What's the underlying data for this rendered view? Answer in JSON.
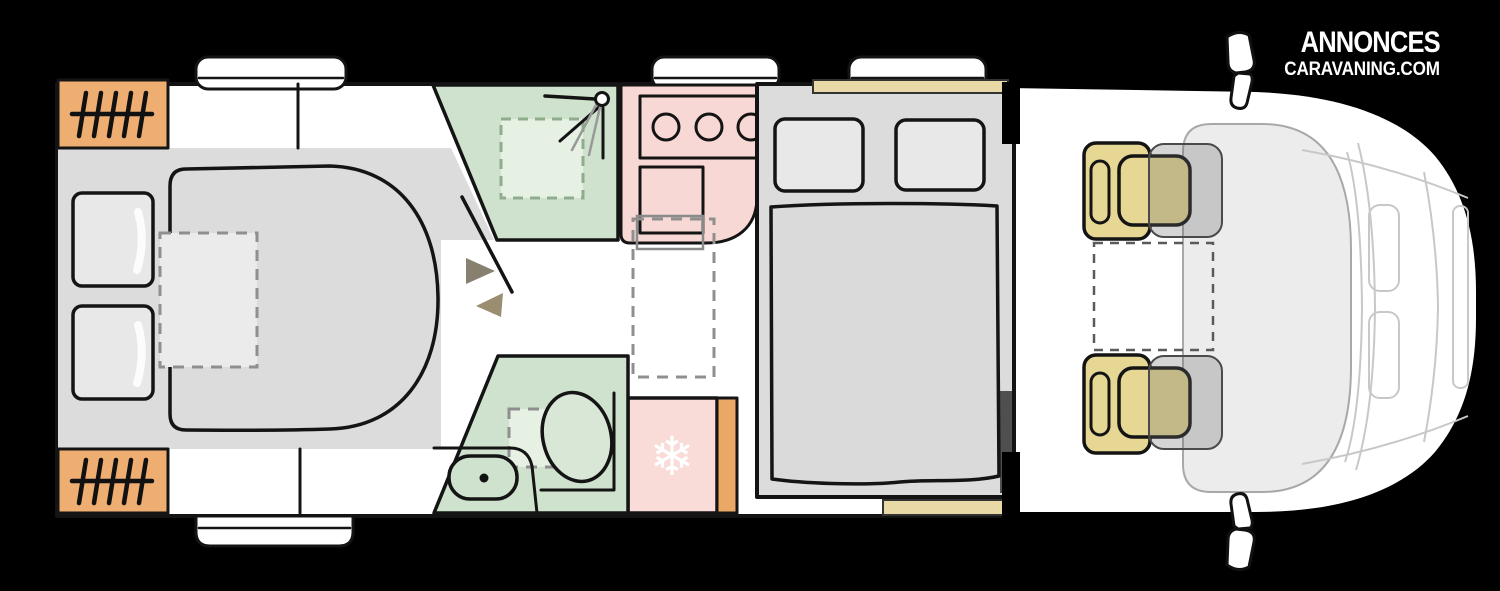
{
  "watermark": {
    "line1": "ANNONCES",
    "line2": "CARAVANING.COM"
  },
  "icons": {
    "snowflake": "❄"
  },
  "palette": {
    "background": "#000000",
    "body_white": "#ffffff",
    "outline_black": "#141414",
    "floor_gray": "#dcdcdc",
    "mattress_gray": "#dadada",
    "pillow_gray": "#e8e8e8",
    "heater_orange": "#efae71",
    "fridge_side_orange": "#e9a865",
    "kitchen_pink": "#f8d8d4",
    "fridge_pink": "#f9dcd8",
    "bath_green": "#cfe2cd",
    "bath_green_light": "#e6f0e3",
    "toilet_green": "#d9e8d6",
    "seat_khaki": "#e7d795",
    "shelf_tan": "#e9d9a7",
    "dash_gray": "#8f8f8f",
    "door_arrow_dark": "#87806f",
    "door_arrow_olive": "#9a8d70",
    "cab_glass_gray": "#ececec",
    "cab_line_gray": "#c8c8c8",
    "bed_side_shadow": "#4f4f4f"
  }
}
